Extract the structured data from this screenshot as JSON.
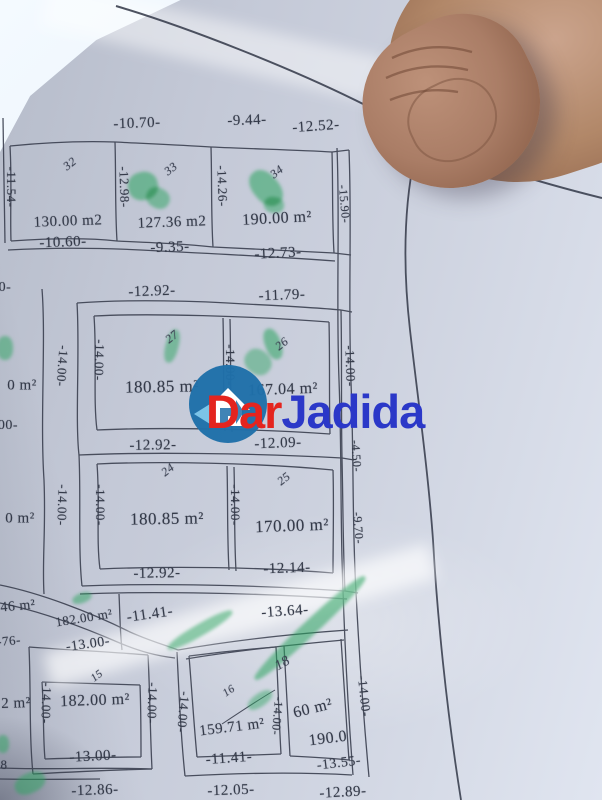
{
  "watermark": {
    "text": "DarJadida",
    "part1": "Dar",
    "part2": "Jadida",
    "colors": {
      "part1": "#e4241e",
      "part2": "#2b38c8",
      "logo": "#1f6fa9",
      "logo_arrow": "#7cc4e8"
    }
  },
  "colors": {
    "ink": "#343a49",
    "paper": "#c8cdda",
    "highlighter_green": "#2aa35e",
    "skin": "#ab8169"
  },
  "plan": {
    "labels": [
      {
        "t": "-10.70-",
        "x": 137,
        "y": 124,
        "r": -2,
        "fs": 15,
        "cls": "dim"
      },
      {
        "t": "-9.44-",
        "x": 247,
        "y": 121,
        "r": -2,
        "fs": 15,
        "cls": "dim"
      },
      {
        "t": "-12.52-",
        "x": 316,
        "y": 127,
        "r": -4,
        "fs": 15,
        "cls": "dim"
      },
      {
        "t": "32",
        "x": 70,
        "y": 164,
        "r": -38,
        "fs": 12,
        "cls": "num"
      },
      {
        "t": "33",
        "x": 171,
        "y": 169,
        "r": -38,
        "fs": 12,
        "cls": "num"
      },
      {
        "t": "34",
        "x": 277,
        "y": 172,
        "r": -38,
        "fs": 12,
        "cls": "num"
      },
      {
        "t": "-11.54-",
        "x": 11,
        "y": 187,
        "r": 90,
        "fs": 13,
        "cls": "dim"
      },
      {
        "t": "-12.98-",
        "x": 124,
        "y": 187,
        "r": 88,
        "fs": 13,
        "cls": "dim"
      },
      {
        "t": "-14.26-",
        "x": 222,
        "y": 186,
        "r": 88,
        "fs": 13,
        "cls": "dim"
      },
      {
        "t": "130.00 m2",
        "x": 68,
        "y": 222,
        "r": -2,
        "fs": 15,
        "cls": "area"
      },
      {
        "t": "127.36 m2",
        "x": 172,
        "y": 223,
        "r": -2,
        "fs": 15,
        "cls": "area"
      },
      {
        "t": "190.00 m²",
        "x": 277,
        "y": 219,
        "r": -3,
        "fs": 16,
        "cls": "area"
      },
      {
        "t": "-10.60-",
        "x": 63,
        "y": 243,
        "r": -2,
        "fs": 15,
        "cls": "dim"
      },
      {
        "t": "-9.35-",
        "x": 170,
        "y": 248,
        "r": -2,
        "fs": 15,
        "cls": "dim"
      },
      {
        "t": "-12.73-",
        "x": 278,
        "y": 254,
        "r": -3,
        "fs": 15,
        "cls": "dim"
      },
      {
        "t": "-15.90-",
        "x": 344,
        "y": 204,
        "r": 85,
        "fs": 12,
        "cls": "dim"
      },
      {
        "t": "-12.92-",
        "x": 152,
        "y": 292,
        "r": -2,
        "fs": 15,
        "cls": "dim"
      },
      {
        "t": "-11.79-",
        "x": 282,
        "y": 296,
        "r": -2,
        "fs": 15,
        "cls": "dim"
      },
      {
        "t": "27",
        "x": 172,
        "y": 337,
        "r": -38,
        "fs": 12,
        "cls": "num"
      },
      {
        "t": "26",
        "x": 282,
        "y": 344,
        "r": -38,
        "fs": 12,
        "cls": "num"
      },
      {
        "t": "-14.00-",
        "x": 62,
        "y": 366,
        "r": 94,
        "fs": 13,
        "cls": "dim"
      },
      {
        "t": "-14.00-",
        "x": 99,
        "y": 360,
        "r": 92,
        "fs": 13,
        "cls": "dim"
      },
      {
        "t": "-14.00-",
        "x": 230,
        "y": 365,
        "r": 90,
        "fs": 13,
        "cls": "dim"
      },
      {
        "t": "-14.00-",
        "x": 350,
        "y": 366,
        "r": 88,
        "fs": 13,
        "cls": "dim"
      },
      {
        "t": "180.85 m²",
        "x": 162,
        "y": 387,
        "r": -1,
        "fs": 17,
        "cls": "area"
      },
      {
        "t": "167.04 m²",
        "x": 283,
        "y": 390,
        "r": -2,
        "fs": 16,
        "cls": "area"
      },
      {
        "t": "-12.92-",
        "x": 153,
        "y": 446,
        "r": -1,
        "fs": 15,
        "cls": "dim"
      },
      {
        "t": "-12.09-",
        "x": 278,
        "y": 444,
        "r": -2,
        "fs": 15,
        "cls": "dim"
      },
      {
        "t": "24",
        "x": 168,
        "y": 470,
        "r": -38,
        "fs": 12,
        "cls": "num"
      },
      {
        "t": "25",
        "x": 284,
        "y": 479,
        "r": -38,
        "fs": 12,
        "cls": "num"
      },
      {
        "t": "-14.00-",
        "x": 62,
        "y": 505,
        "r": 92,
        "fs": 13,
        "cls": "dim"
      },
      {
        "t": "-14.00-",
        "x": 100,
        "y": 505,
        "r": 90,
        "fs": 13,
        "cls": "dim"
      },
      {
        "t": "-14.00-",
        "x": 235,
        "y": 505,
        "r": 90,
        "fs": 13,
        "cls": "dim"
      },
      {
        "t": "180.85 m²",
        "x": 167,
        "y": 519,
        "r": -1,
        "fs": 17,
        "cls": "area"
      },
      {
        "t": "170.00 m²",
        "x": 292,
        "y": 526,
        "r": -2,
        "fs": 17,
        "cls": "area"
      },
      {
        "t": "-12.92-",
        "x": 157,
        "y": 574,
        "r": -1,
        "fs": 15,
        "cls": "dim"
      },
      {
        "t": "-12.14-",
        "x": 287,
        "y": 569,
        "r": -2,
        "fs": 15,
        "cls": "dim"
      },
      {
        "t": "-4.50-",
        "x": 356,
        "y": 456,
        "r": 86,
        "fs": 12,
        "cls": "dim"
      },
      {
        "t": "-9.70-",
        "x": 358,
        "y": 528,
        "r": 86,
        "fs": 12,
        "cls": "dim"
      },
      {
        "t": "-14.00-",
        "x": 364,
        "y": 696,
        "r": 84,
        "fs": 13,
        "cls": "dim"
      },
      {
        "t": "0 m²",
        "x": 22,
        "y": 386,
        "r": 0,
        "fs": 15,
        "cls": "area"
      },
      {
        "t": "00-",
        "x": 8,
        "y": 426,
        "r": 0,
        "fs": 14,
        "cls": "dim"
      },
      {
        "t": "0 m²",
        "x": 20,
        "y": 519,
        "r": 0,
        "fs": 15,
        "cls": "area"
      },
      {
        "t": "0-",
        "x": 5,
        "y": 288,
        "r": 0,
        "fs": 14,
        "cls": "dim"
      },
      {
        "t": "-11.41-",
        "x": 150,
        "y": 615,
        "r": -8,
        "fs": 15,
        "cls": "dim"
      },
      {
        "t": "-13.64-",
        "x": 285,
        "y": 612,
        "r": -4,
        "fs": 15,
        "cls": "dim"
      },
      {
        "t": "46 m²",
        "x": 18,
        "y": 607,
        "r": -5,
        "fs": 14,
        "cls": "area"
      },
      {
        "t": "182.00 m²",
        "x": 84,
        "y": 618,
        "r": -9,
        "fs": 13,
        "cls": "area"
      },
      {
        "t": "-76-",
        "x": 9,
        "y": 641,
        "r": -5,
        "fs": 13,
        "cls": "dim"
      },
      {
        "t": "-13.00-",
        "x": 88,
        "y": 645,
        "r": -8,
        "fs": 14,
        "cls": "dim"
      },
      {
        "t": "15",
        "x": 97,
        "y": 676,
        "r": -38,
        "fs": 11,
        "cls": "num"
      },
      {
        "t": "-14.00-",
        "x": 46,
        "y": 703,
        "r": 92,
        "fs": 13,
        "cls": "dim"
      },
      {
        "t": "182.00 m²",
        "x": 95,
        "y": 701,
        "r": -2,
        "fs": 16,
        "cls": "area"
      },
      {
        "t": "2 m²",
        "x": 16,
        "y": 704,
        "r": -2,
        "fs": 15,
        "cls": "area"
      },
      {
        "t": "-14.00-",
        "x": 152,
        "y": 703,
        "r": 92,
        "fs": 13,
        "cls": "dim"
      },
      {
        "t": "-13.00-",
        "x": 93,
        "y": 757,
        "r": -3,
        "fs": 15,
        "cls": "dim"
      },
      {
        "t": "-12.86-",
        "x": 95,
        "y": 791,
        "r": -2,
        "fs": 15,
        "cls": "dim"
      },
      {
        "t": "16",
        "x": 229,
        "y": 691,
        "r": -35,
        "fs": 11,
        "cls": "num"
      },
      {
        "t": "18",
        "x": 283,
        "y": 664,
        "r": -30,
        "fs": 14,
        "cls": "num"
      },
      {
        "t": "-14.00-",
        "x": 183,
        "y": 712,
        "r": 95,
        "fs": 13,
        "cls": "dim"
      },
      {
        "t": "-14.00-",
        "x": 277,
        "y": 716,
        "r": 95,
        "fs": 12,
        "cls": "dim"
      },
      {
        "t": "159.71 m²",
        "x": 232,
        "y": 728,
        "r": -7,
        "fs": 15,
        "cls": "area"
      },
      {
        "t": "-11.41-",
        "x": 229,
        "y": 759,
        "r": -4,
        "fs": 15,
        "cls": "dim"
      },
      {
        "t": "60 m²",
        "x": 313,
        "y": 709,
        "r": -14,
        "fs": 16,
        "cls": "area"
      },
      {
        "t": "190.0",
        "x": 328,
        "y": 739,
        "r": -7,
        "fs": 16,
        "cls": "area"
      },
      {
        "t": "-13.55-",
        "x": 339,
        "y": 764,
        "r": -7,
        "fs": 14,
        "cls": "dim"
      },
      {
        "t": "-12.05-",
        "x": 231,
        "y": 791,
        "r": -2,
        "fs": 15,
        "cls": "dim"
      },
      {
        "t": "-12.89-",
        "x": 343,
        "y": 793,
        "r": -3,
        "fs": 15,
        "cls": "dim"
      },
      {
        "t": "8",
        "x": 4,
        "y": 765,
        "r": 0,
        "fs": 13,
        "cls": "dim"
      }
    ],
    "green_marks": [
      {
        "x": 143,
        "y": 186,
        "w": 30,
        "h": 28,
        "r": -15,
        "o": 0.55
      },
      {
        "x": 158,
        "y": 198,
        "w": 24,
        "h": 20,
        "r": 30,
        "o": 0.5
      },
      {
        "x": 266,
        "y": 188,
        "w": 26,
        "h": 40,
        "r": -40,
        "o": 0.55
      },
      {
        "x": 274,
        "y": 205,
        "w": 20,
        "h": 16,
        "r": 10,
        "o": 0.5
      },
      {
        "x": 172,
        "y": 346,
        "w": 13,
        "h": 34,
        "r": 14,
        "o": 0.5
      },
      {
        "x": 273,
        "y": 344,
        "w": 16,
        "h": 32,
        "r": -20,
        "o": 0.55
      },
      {
        "x": 258,
        "y": 362,
        "w": 28,
        "h": 24,
        "r": 40,
        "o": 0.45
      },
      {
        "x": 5,
        "y": 348,
        "w": 16,
        "h": 24,
        "r": 0,
        "o": 0.5
      },
      {
        "x": 3,
        "y": 744,
        "w": 12,
        "h": 18,
        "r": 0,
        "o": 0.5
      },
      {
        "x": 30,
        "y": 783,
        "w": 32,
        "h": 20,
        "r": -25,
        "o": 0.5
      },
      {
        "x": 310,
        "y": 628,
        "w": 150,
        "h": 15,
        "r": -43,
        "o": 0.55
      },
      {
        "x": 200,
        "y": 630,
        "w": 74,
        "h": 12,
        "r": -30,
        "o": 0.5
      },
      {
        "x": 82,
        "y": 598,
        "w": 20,
        "h": 10,
        "r": -20,
        "o": 0.5
      },
      {
        "x": 260,
        "y": 700,
        "w": 28,
        "h": 13,
        "r": -35,
        "o": 0.45
      }
    ]
  }
}
